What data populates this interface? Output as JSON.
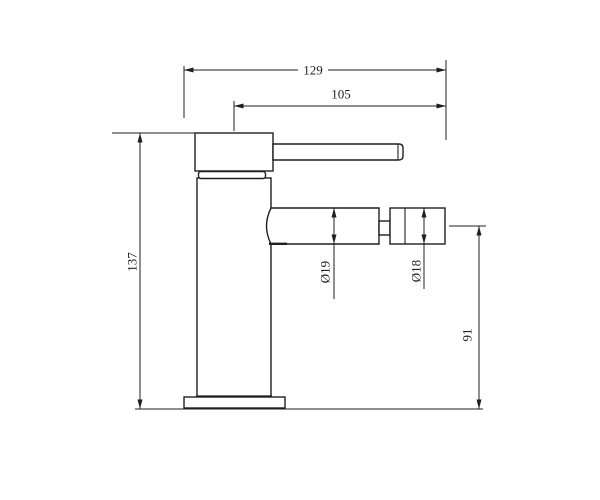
{
  "colors": {
    "background": "#ffffff",
    "line": "#1f1f1f"
  },
  "dimensions": {
    "overall_width": {
      "label": "129"
    },
    "spout_reach": {
      "label": "105"
    },
    "overall_height": {
      "label": "137"
    },
    "spout_diameter": {
      "label": "Ø19"
    },
    "aerator_diameter": {
      "label": "Ø18"
    },
    "spout_axis_height": {
      "label": "91"
    }
  }
}
